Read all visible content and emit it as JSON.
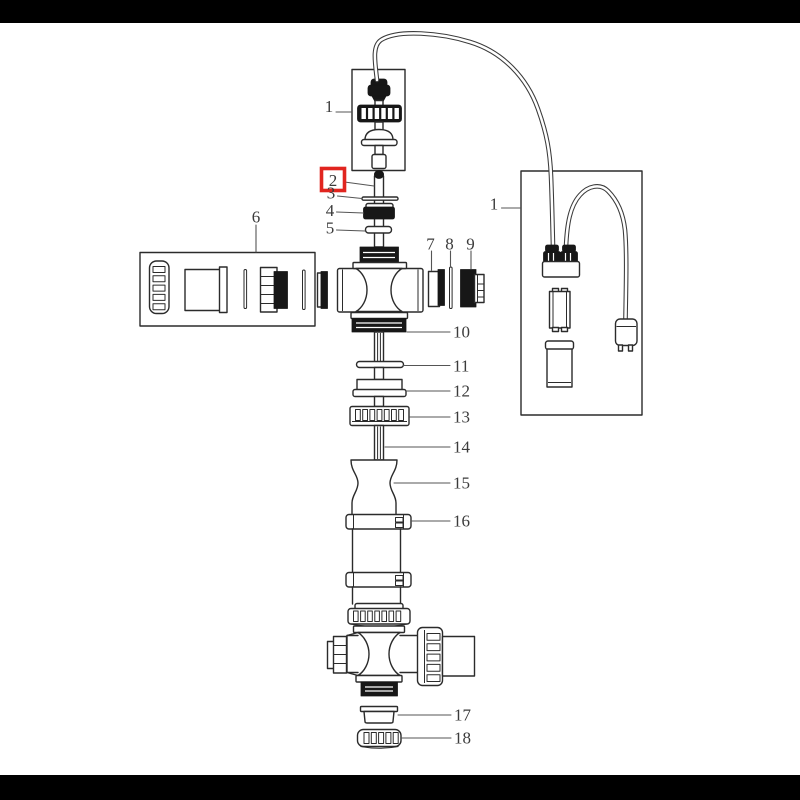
{
  "scene": {
    "background": "#ffffff",
    "letterbox_color": "#000000",
    "line_color": "#2b2b2b",
    "label_color": "#3b3b3b"
  },
  "diagram": {
    "kind": "exploded-parts-diagram",
    "highlight": {
      "part": "2",
      "box_color": "#e1251f"
    },
    "labels": [
      {
        "text": "1"
      },
      {
        "text": "2"
      },
      {
        "text": "3"
      },
      {
        "text": "4"
      },
      {
        "text": "5"
      },
      {
        "text": "6"
      },
      {
        "text": "7"
      },
      {
        "text": "8"
      },
      {
        "text": "9"
      },
      {
        "text": "10"
      },
      {
        "text": "11"
      },
      {
        "text": "12"
      },
      {
        "text": "13"
      },
      {
        "text": "14"
      },
      {
        "text": "15"
      },
      {
        "text": "16"
      },
      {
        "text": "1"
      },
      {
        "text": "17"
      },
      {
        "text": "18"
      }
    ]
  }
}
